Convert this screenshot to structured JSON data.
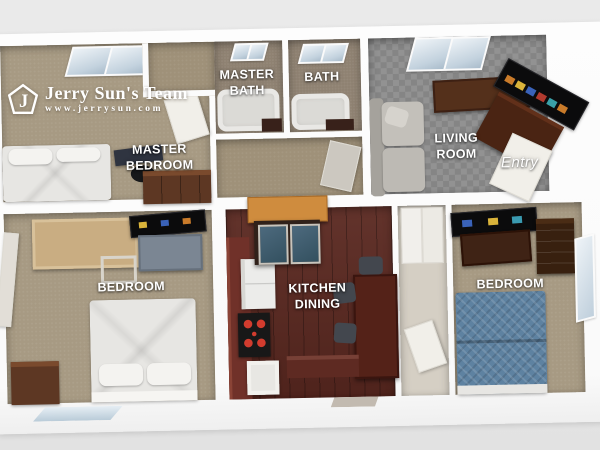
{
  "watermark": {
    "brand": "Jerry Sun's Team",
    "website": "www.jerrysun.com",
    "monogram": "J"
  },
  "rooms": {
    "master_bedroom": {
      "label": "MASTER BEDROOM"
    },
    "master_bath": {
      "label": "MASTER BATH"
    },
    "bath": {
      "label": "BATH"
    },
    "living_room": {
      "label": "LIVING ROOM"
    },
    "entry": {
      "label": "Entry"
    },
    "bedroom_left": {
      "label": "BEDROOM"
    },
    "kitchen_dining": {
      "label": "KITCHEN DINING"
    },
    "bedroom_right": {
      "label": "BEDROOM"
    }
  },
  "colors": {
    "background": "#e8e8e8",
    "walls": "#fdfdfd",
    "carpet_tan": "#a79a83",
    "carpet_gray": "#8d8d8d",
    "bath_floor": "#8f8272",
    "kitchen_floor": "#5a2820",
    "wood_dark": "#5d3723",
    "wood_light": "#c9ad82",
    "hutch_top": "#cf8c3e",
    "bed_blue": "#5e82a1",
    "label_text": "#ffffff"
  }
}
